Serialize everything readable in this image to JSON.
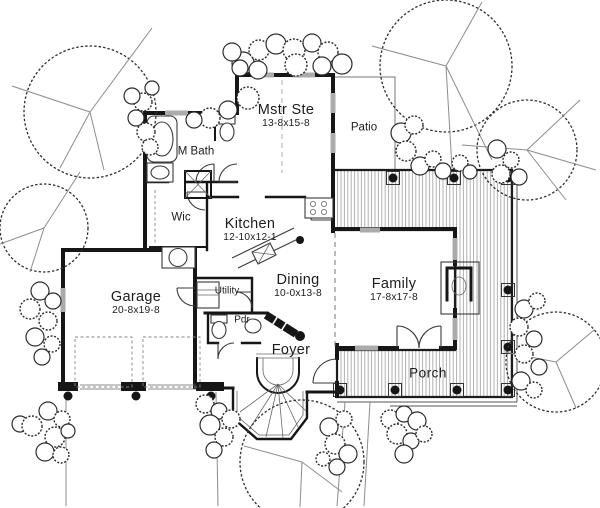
{
  "rooms": {
    "mstr_ste": {
      "name": "Mstr Ste",
      "dims": "13-8x15-8"
    },
    "m_bath": {
      "name": "M Bath"
    },
    "patio": {
      "name": "Patio"
    },
    "wic": {
      "name": "Wic"
    },
    "kitchen": {
      "name": "Kitchen",
      "dims": "12-10x12-1"
    },
    "utility": {
      "name": "Utility"
    },
    "dining": {
      "name": "Dining",
      "dims": "10-0x13-8"
    },
    "family": {
      "name": "Family",
      "dims": "17-8x17-8"
    },
    "garage": {
      "name": "Garage",
      "dims": "20-8x19-8"
    },
    "pdr": {
      "name": "Pdr"
    },
    "foyer": {
      "name": "Foyer"
    },
    "porch": {
      "name": "Porch"
    }
  },
  "colors": {
    "wall": "#161616",
    "line": "#3a3a3a",
    "soft": "#8c8c8c",
    "hatch": "#9d9d9d",
    "text": "#1c1c1c",
    "bg": "#ffffff"
  }
}
